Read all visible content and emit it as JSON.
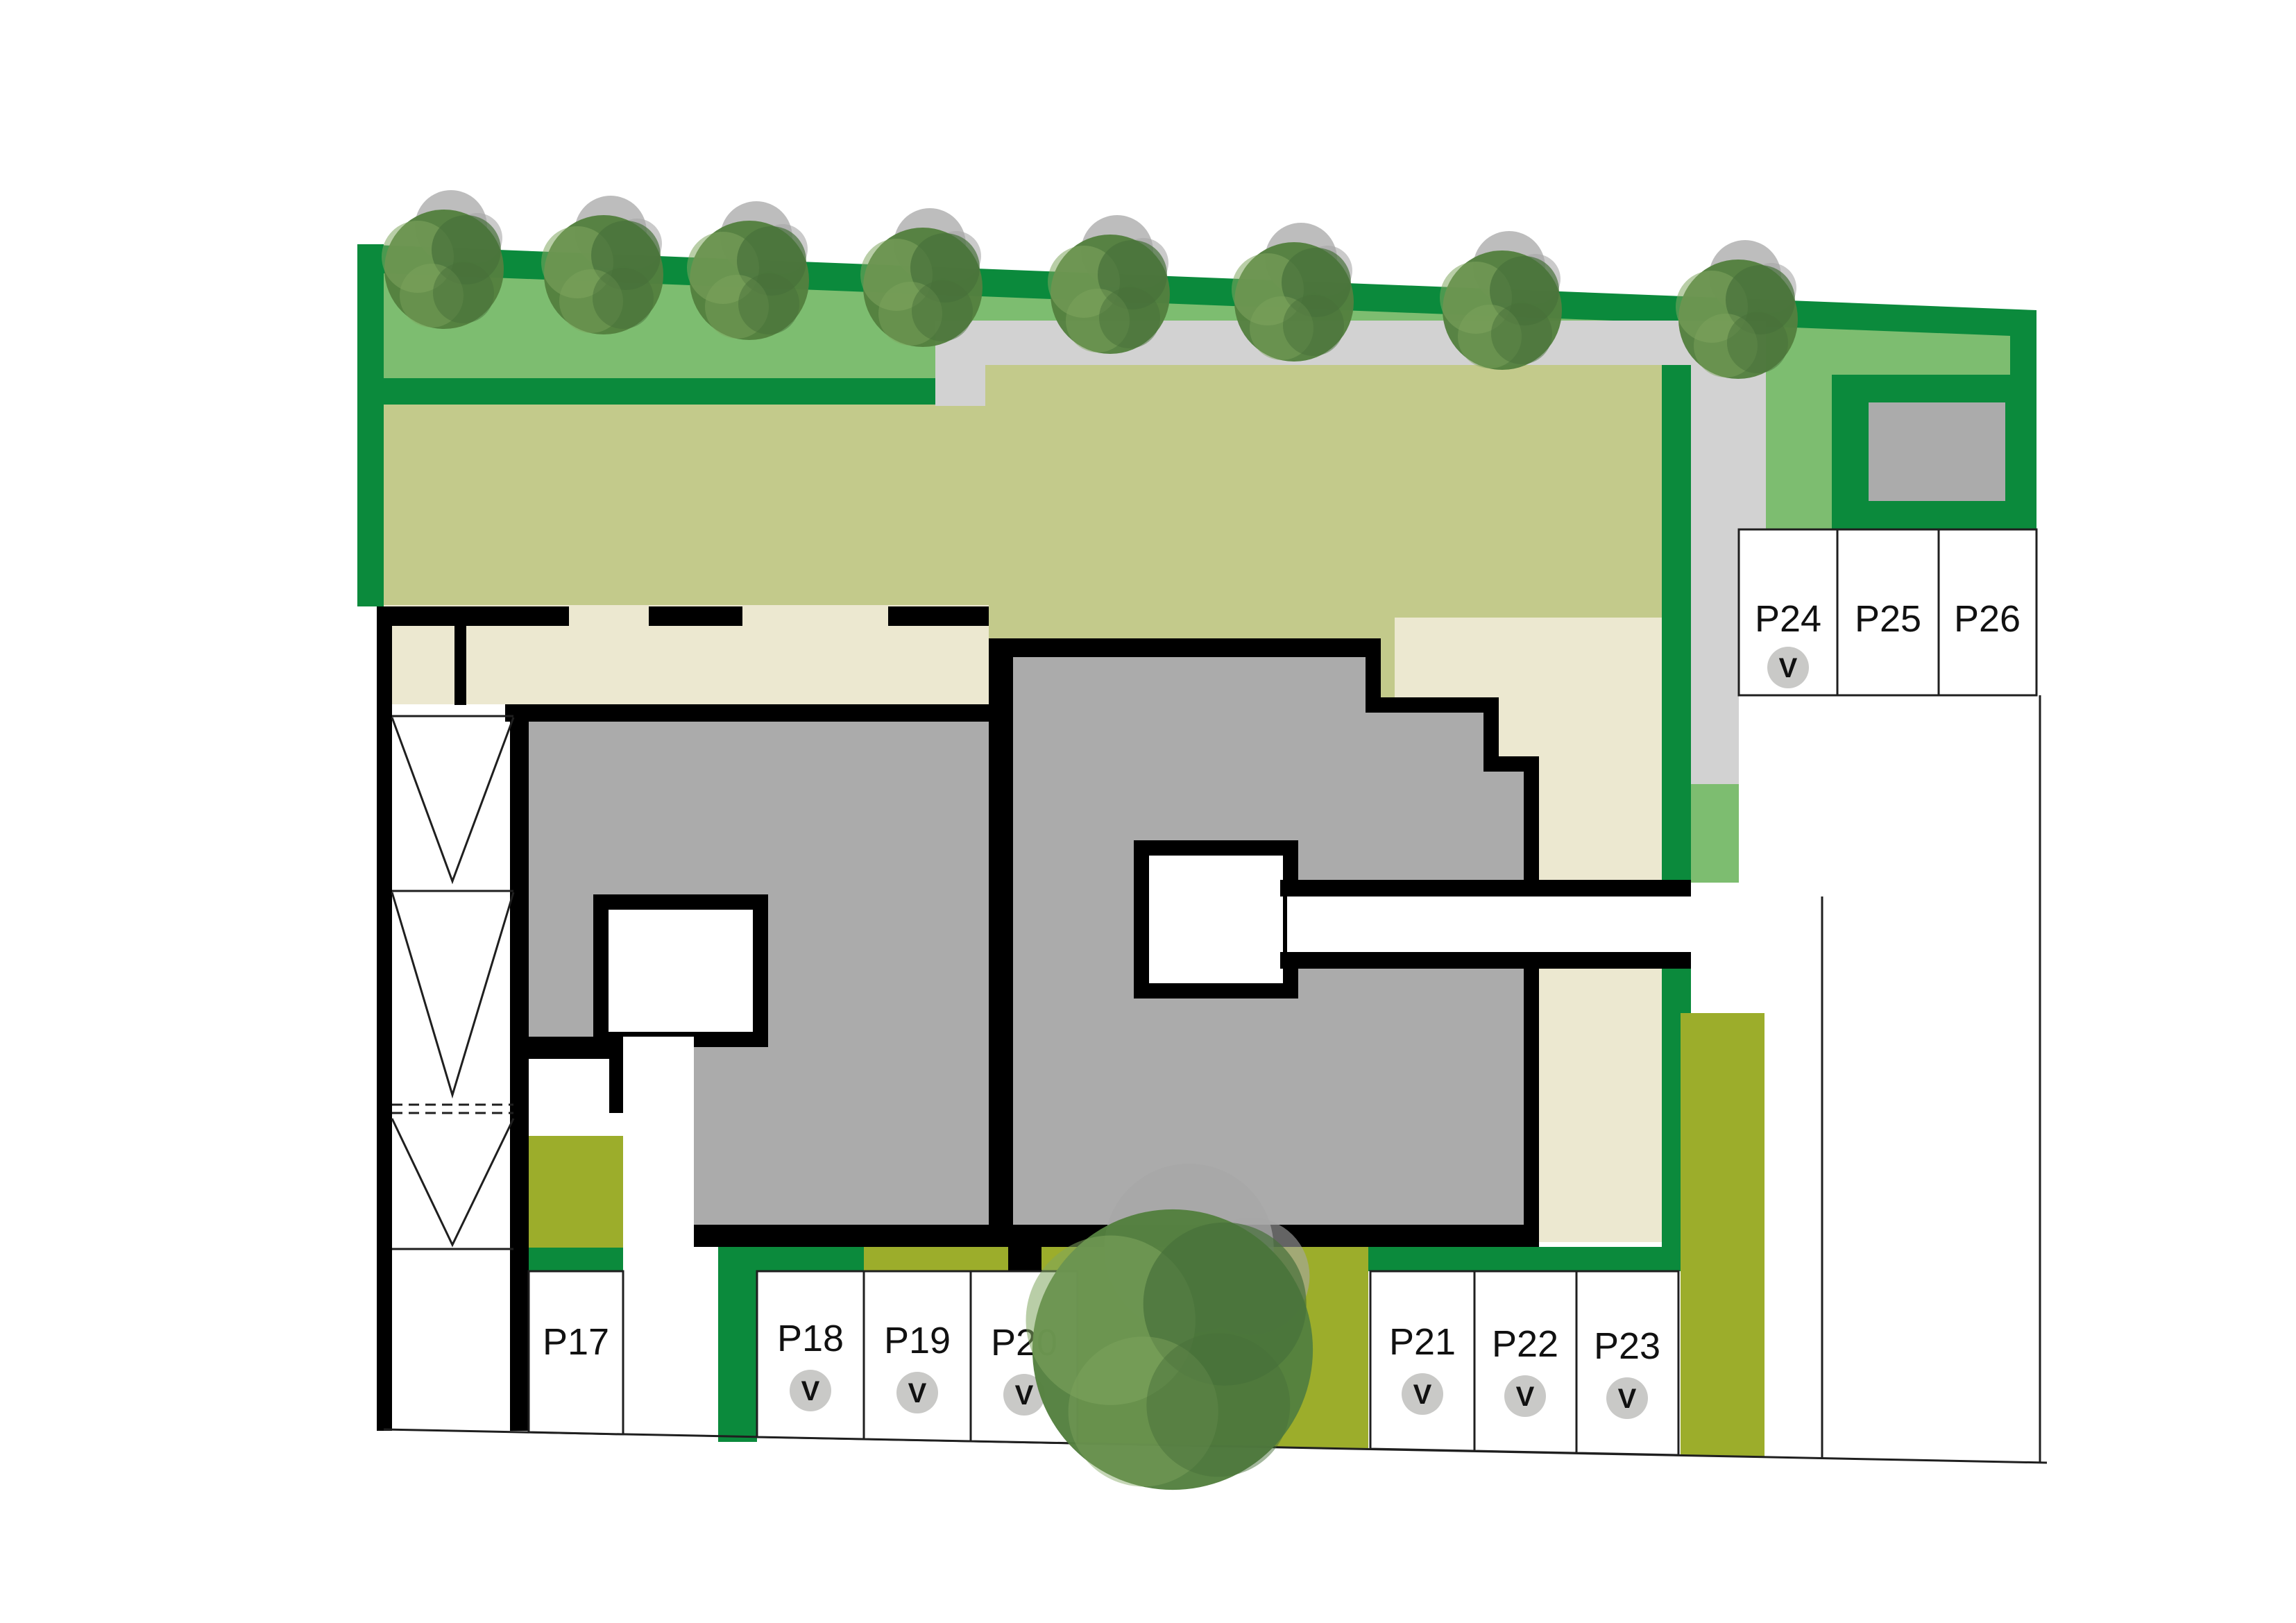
{
  "colors": {
    "hedge": "#0B8A3C",
    "lawn": "#7DBD70",
    "garden": "#C3CA8B",
    "terrace": "#ECE8D0",
    "building": "#ABABAB",
    "walkway": "#D2D2D2",
    "meadow": "#9CAD2B",
    "outline": "#000000",
    "stall": "#FFFFFF",
    "badge": "#C9C9C7",
    "tree-core": "#54803F",
    "tree-light": "#7FA55E",
    "tree-dark": "#47703A",
    "tree-shadow": "#A7A7A7"
  },
  "parking": {
    "valet_badge": "V",
    "bottom_row": [
      {
        "label": "P17",
        "valet": false
      },
      {
        "label": "P18",
        "valet": true
      },
      {
        "label": "P19",
        "valet": true
      },
      {
        "label": "P20",
        "valet": true
      },
      {
        "label": "P21",
        "valet": true
      },
      {
        "label": "P22",
        "valet": true
      },
      {
        "label": "P23",
        "valet": true
      }
    ],
    "right_row": [
      {
        "label": "P24",
        "valet": true
      },
      {
        "label": "P25",
        "valet": false
      },
      {
        "label": "P26",
        "valet": false
      }
    ]
  },
  "site": {
    "trees_along_hedge": 8,
    "large_trees": 1
  }
}
